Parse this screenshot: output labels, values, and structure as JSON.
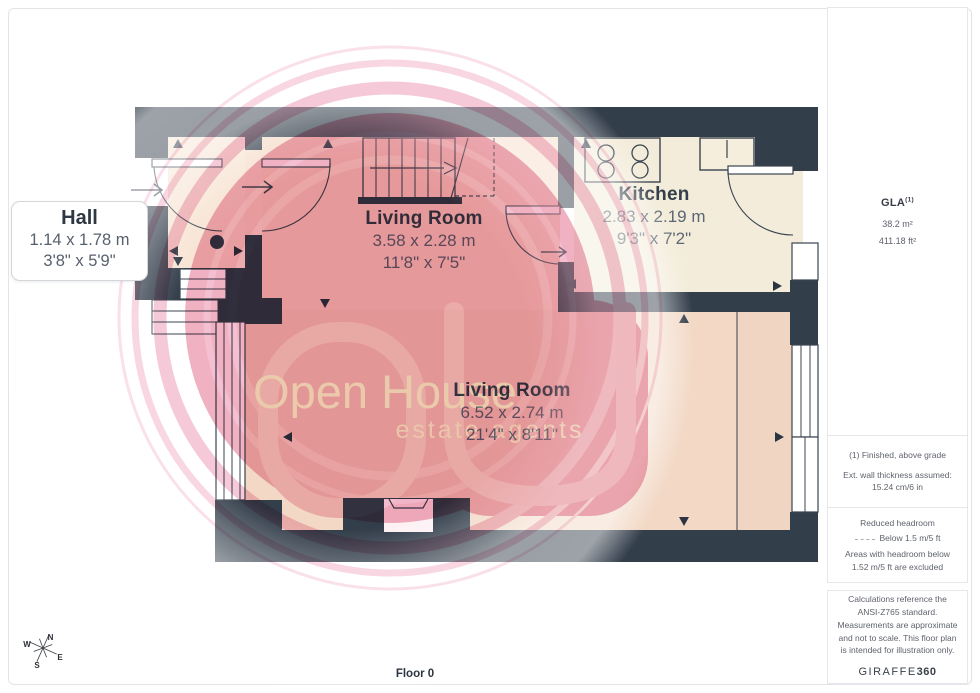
{
  "plan": {
    "floor_label": "Floor 0",
    "rooms": [
      {
        "name": "Hall",
        "metric": "1.14 x 1.78 m",
        "imperial": "3'8\" x 5'9\""
      },
      {
        "name": "Living Room",
        "metric": "3.58 x 2.28 m",
        "imperial": "11'8\" x 7'5\""
      },
      {
        "name": "Kitchen",
        "metric": "2.83 x 2.19 m",
        "imperial": "9'3\" x 7'2\""
      },
      {
        "name": "Living Room",
        "metric": "6.52 x 2.74 m",
        "imperial": "21'4\" x 8'11\""
      }
    ],
    "compass": {
      "n": "N",
      "e": "E",
      "s": "S",
      "w": "W"
    }
  },
  "watermark": {
    "title": "Open House",
    "subtitle": "estate agents"
  },
  "sidebar": {
    "gla": {
      "label": "GLA",
      "sup": "(1)",
      "area_metric": "38.2 m²",
      "area_imperial": "411.18 ft²"
    },
    "wall_note": {
      "line1": "(1) Finished, above grade",
      "line2": "Ext. wall thickness assumed: 15.24 cm/6 in"
    },
    "headroom": {
      "title": "Reduced headroom",
      "legend": "Below 1.5 m/5 ft",
      "note": "Areas with headroom below 1.52 m/5 ft are excluded"
    },
    "disclaimer": {
      "text": "Calculations reference the ANSI-Z765 standard. Measurements are approximate and not to scale. This floor plan is intended for illustration only.",
      "brand_main": "GIRAFFE",
      "brand_suffix": "360"
    }
  },
  "colors": {
    "wall": "#333e4b",
    "floor_warm": "#f2d8c5",
    "floor_cream": "#f3ecda",
    "watermark_pink": "#efaabd",
    "text_dark": "#343f4b"
  }
}
